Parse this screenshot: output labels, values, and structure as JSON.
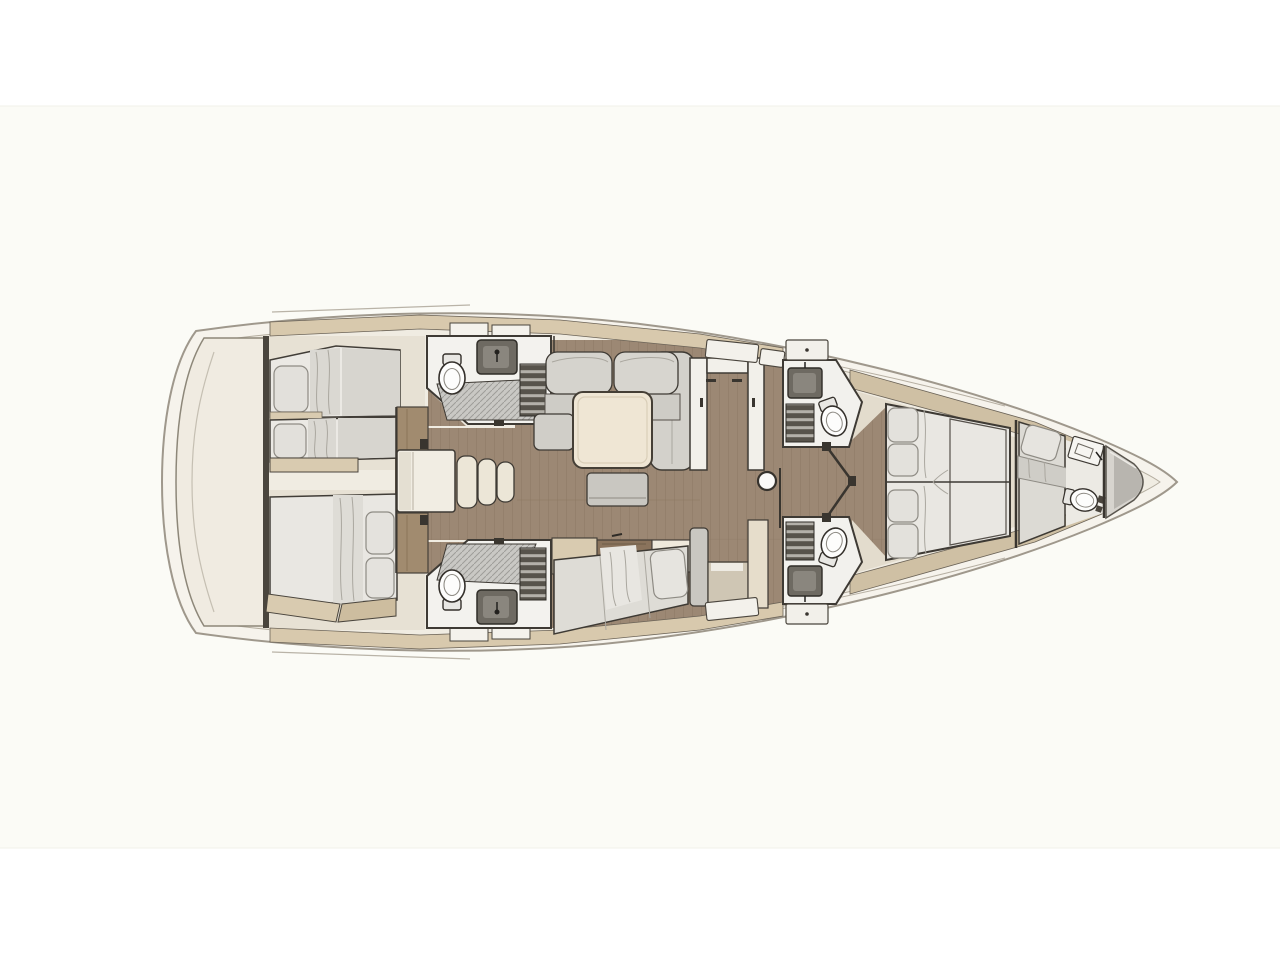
{
  "plan": {
    "type": "yacht-interior-floor-plan",
    "orientation": "bow-right-stern-left",
    "areas": [
      {
        "id": "swim-platform",
        "label": "transom swim platform"
      },
      {
        "id": "aft-cabin-port",
        "label": "aft cabin with twin single berths"
      },
      {
        "id": "aft-cabin-starboard",
        "label": "aft cabin with double berth"
      },
      {
        "id": "aft-head-port",
        "label": "aft head with shower, toilet and sink"
      },
      {
        "id": "aft-head-starboard",
        "label": "aft head with shower, toilet and sink"
      },
      {
        "id": "companionway",
        "label": "companionway steps"
      },
      {
        "id": "salon",
        "label": "salon with L-sofa, table and bench"
      },
      {
        "id": "galley",
        "label": "U-shaped galley counter"
      },
      {
        "id": "settee-starboard",
        "label": "straight settee with sideboard"
      },
      {
        "id": "mast-post",
        "label": "mast post"
      },
      {
        "id": "forward-head-port",
        "label": "forward head with toilet and sink"
      },
      {
        "id": "forward-head-starboard",
        "label": "forward head with toilet and sink"
      },
      {
        "id": "owners-cabin",
        "label": "forward owner cabin with island double bed"
      },
      {
        "id": "bow-cabin",
        "label": "bow compartment with single berth and day head"
      },
      {
        "id": "anchor-locker",
        "label": "anchor locker"
      }
    ],
    "inventory": {
      "toilets": 5,
      "sinks": 5,
      "shower-grates": 2,
      "double-beds": 2,
      "single-berths": 3,
      "sofas": 2,
      "tables": 2,
      "companionway-steps": 3
    }
  },
  "palette": {
    "page": "#ffffff",
    "canvasBand": "#fbfbf6",
    "hullFill": "#f6f3ec",
    "hullStroke": "#9f988c",
    "deckFill": "#f0ece2",
    "deckStroke": "#b4ad9f",
    "platform": "#f0ebe1",
    "tanBand": "#d8c9ad",
    "tanShelf": "#d9cbb0",
    "wood": "#9c8874",
    "woodLine": "#8b7762",
    "woodCabinet": "#a18b6f",
    "cabinFloor": "#e7e1d4",
    "mattress": "#e9e7e2",
    "pillow": "#e2e0db",
    "sofaGray": "#d5d3cd",
    "benchGray": "#c9c7c1",
    "tableCream": "#efe6d4",
    "stepCream": "#ece6d7",
    "roomWhite": "#f3f2ee",
    "fixtureWhite": "#fdfdfc",
    "sinkDark": "#6e6a62",
    "slatDark": "#57534b",
    "slatBar": "#b3b0a9",
    "grate": "#c9c8c4",
    "grateLine": "#9e9d99",
    "anchorLight": "#d7d4ce",
    "anchorDark": "#b8b5af",
    "ink": "#3e3a34"
  }
}
